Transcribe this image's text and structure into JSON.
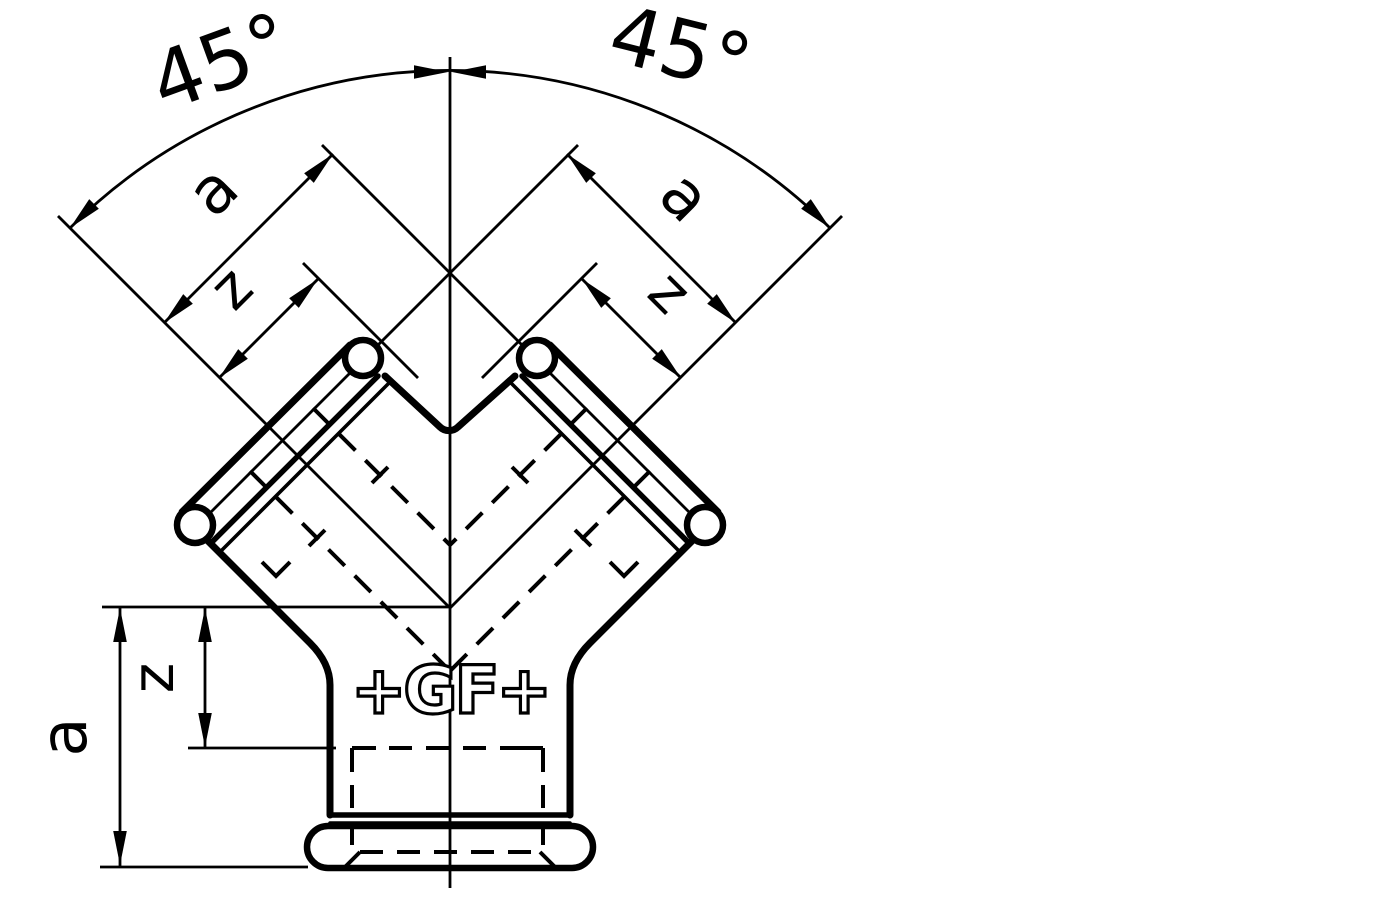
{
  "labels": {
    "angle_left": "45°",
    "angle_right": "45°",
    "a_branch_left": "a",
    "a_branch_right": "a",
    "z_branch_left": "z",
    "z_branch_right": "z",
    "a_bottom": "a",
    "z_bottom": "z"
  },
  "logo": {
    "text": "+GF+"
  },
  "colors": {
    "line": "#000000",
    "background": "#ffffff"
  }
}
